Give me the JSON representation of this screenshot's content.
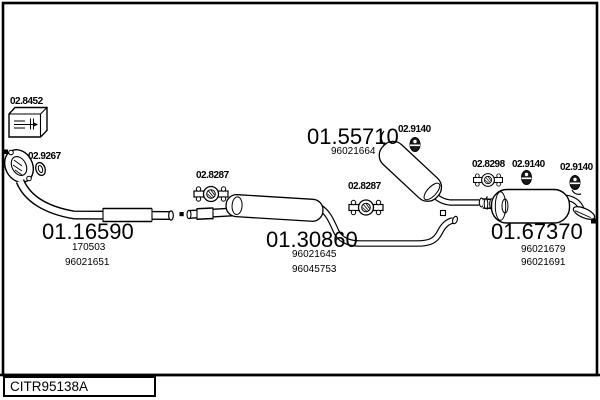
{
  "frame": {
    "drawing_code": "CITR95138A"
  },
  "colors": {
    "line": "#000000",
    "background": "#ffffff"
  },
  "parts": {
    "gasket_kit": {
      "ref": "02.8452"
    },
    "seal_ring": {
      "ref": "02.9267"
    },
    "front_pipe": {
      "ref": "01.16590",
      "alt1": "170503",
      "alt2": "96021651"
    },
    "clamp_front": {
      "ref": "02.8287"
    },
    "centre_silencer": {
      "ref": "01.30860",
      "alt1": "96021645",
      "alt2": "96045753"
    },
    "clamp_mid": {
      "ref": "02.8287"
    },
    "mid_silencer": {
      "ref": "01.55710",
      "alt1": "96021664"
    },
    "hanger_mid": {
      "ref": "02.9140"
    },
    "clamp_rear": {
      "ref": "02.8298"
    },
    "hanger_rear1": {
      "ref": "02.9140"
    },
    "hanger_rear2": {
      "ref": "02.9140"
    },
    "rear_silencer": {
      "ref": "01.67370",
      "alt1": "96021679",
      "alt2": "96021691"
    }
  }
}
